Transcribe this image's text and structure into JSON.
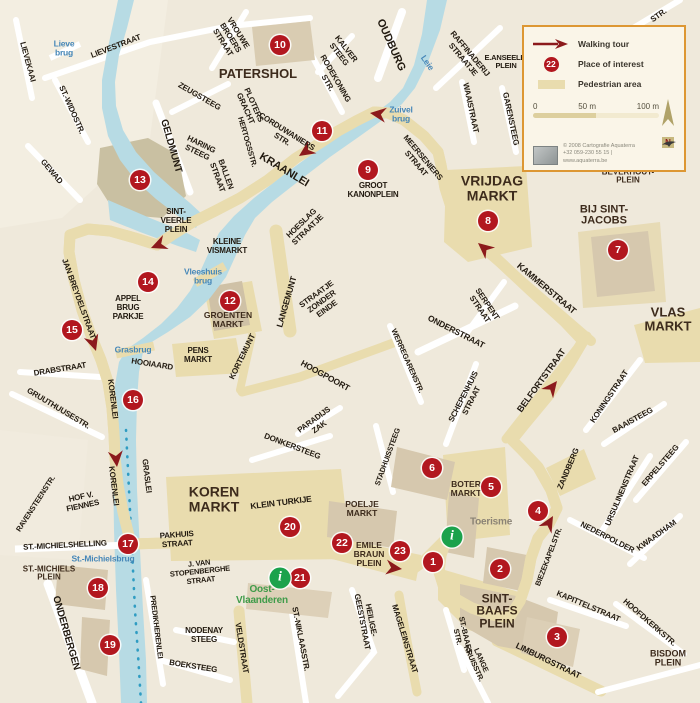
{
  "colors": {
    "water": "#b7dbe4",
    "route": "#8c1a1c",
    "poi": "#b2171f",
    "pedestrian": "#e9dcae",
    "info_green": "#1ba24c",
    "legend_border": "#dd9733",
    "water_label": "#4687b8"
  },
  "legend": {
    "walking_tour": "Walking tour",
    "poi_badge": "22",
    "place_of_interest": "Place of interest",
    "pedestrian_area": "Pedestrian area",
    "scale_0": "0",
    "scale_50": "50 m",
    "scale_100": "100 m",
    "compass": "N",
    "credit_1": "© 2008 Cartografie Aquaterra",
    "credit_2": "+32 059-230 55 15 | www.aquaterra.be"
  },
  "map": {
    "info_glyph": "i",
    "labels": [
      {
        "t": "LIEVEKAAI",
        "x": 27,
        "y": 62,
        "r": 75,
        "fs": 8,
        "k": "street"
      },
      {
        "t": "LIEVESTRAAT",
        "x": 116,
        "y": 47,
        "r": -21,
        "fs": 8,
        "k": "street"
      },
      {
        "t": "Lieve\nbrug",
        "x": 64,
        "y": 49,
        "r": 0,
        "fs": 8.5,
        "k": "water"
      },
      {
        "t": "ST.-WIDOSTR.",
        "x": 71,
        "y": 110,
        "r": 66,
        "fs": 8,
        "k": "street"
      },
      {
        "t": "GEWAD",
        "x": 51,
        "y": 172,
        "r": 50,
        "fs": 8,
        "k": "street"
      },
      {
        "t": "GELDMUNT",
        "x": 171,
        "y": 146,
        "r": 74,
        "fs": 10,
        "k": "street"
      },
      {
        "t": "VROUWE\nBROERS\nSTRAAT",
        "x": 230,
        "y": 38,
        "r": 58,
        "fs": 8,
        "k": "street"
      },
      {
        "t": "PATERSHOL",
        "x": 258,
        "y": 74,
        "r": 0,
        "fs": 13,
        "k": "area"
      },
      {
        "t": "KALVER\nSTEEG",
        "x": 342,
        "y": 52,
        "r": 52,
        "fs": 8,
        "k": "street"
      },
      {
        "t": "RODEKONING\nSTR.",
        "x": 331,
        "y": 81,
        "r": 60,
        "fs": 8,
        "k": "street"
      },
      {
        "t": "ZEUGSTEEG",
        "x": 199,
        "y": 97,
        "r": 30,
        "fs": 8,
        "k": "street"
      },
      {
        "t": "PLOTERS\nGRACHT",
        "x": 249,
        "y": 107,
        "r": 66,
        "fs": 8,
        "k": "street"
      },
      {
        "t": "HARING\nSTEEG",
        "x": 199,
        "y": 149,
        "r": 26,
        "fs": 8,
        "k": "street"
      },
      {
        "t": "HERTOGSSTR.",
        "x": 247,
        "y": 142,
        "r": 74,
        "fs": 7.5,
        "k": "street"
      },
      {
        "t": "BALLEN\nSTRAAT",
        "x": 221,
        "y": 176,
        "r": 70,
        "fs": 8,
        "k": "street"
      },
      {
        "t": "CORDUWANIERS\nSTR.",
        "x": 284,
        "y": 136,
        "r": 32,
        "fs": 8,
        "k": "street"
      },
      {
        "t": "KRAANLEI",
        "x": 284,
        "y": 170,
        "r": 31,
        "fs": 11,
        "k": "street"
      },
      {
        "t": "OUDBURG",
        "x": 391,
        "y": 45,
        "r": 66,
        "fs": 11,
        "k": "street"
      },
      {
        "t": "Leie",
        "x": 427,
        "y": 63,
        "r": 55,
        "fs": 8.5,
        "k": "water"
      },
      {
        "t": "RAFFINADERIJ\nSTRAATJE",
        "x": 466,
        "y": 57,
        "r": 50,
        "fs": 8,
        "k": "street"
      },
      {
        "t": "E.ANSEELE-\nPLEIN",
        "x": 506,
        "y": 62,
        "r": 0,
        "fs": 7.5,
        "k": "street"
      },
      {
        "t": "WAAISTRAAT",
        "x": 470,
        "y": 108,
        "r": 78,
        "fs": 8,
        "k": "street"
      },
      {
        "t": "GARENSTEEG",
        "x": 510,
        "y": 119,
        "r": 78,
        "fs": 8,
        "k": "street"
      },
      {
        "t": "STR.",
        "x": 659,
        "y": 16,
        "r": -36,
        "fs": 8,
        "k": "street"
      },
      {
        "t": "Zuivel\nbrug",
        "x": 401,
        "y": 115,
        "r": 0,
        "fs": 8.5,
        "k": "water"
      },
      {
        "t": "MEERSENIERS\nSTRAAT",
        "x": 419,
        "y": 161,
        "r": 50,
        "fs": 8,
        "k": "street"
      },
      {
        "t": "GROOT\nKANONPLEIN",
        "x": 373,
        "y": 191,
        "r": 0,
        "fs": 8,
        "k": "street"
      },
      {
        "t": "VRIJDAG\nMARKT",
        "x": 492,
        "y": 188,
        "r": 0,
        "fs": 14,
        "k": "area"
      },
      {
        "t": "BEVERHOUT-\nPLEIN",
        "x": 628,
        "y": 177,
        "r": 0,
        "fs": 8,
        "k": "area"
      },
      {
        "t": "BIJ SINT-\nJACOBS",
        "x": 604,
        "y": 216,
        "r": 0,
        "fs": 11,
        "k": "area"
      },
      {
        "t": "VLAS\nMARKT",
        "x": 668,
        "y": 319,
        "r": 0,
        "fs": 13,
        "k": "area"
      },
      {
        "t": "KAMMERSTRAAT",
        "x": 546,
        "y": 289,
        "r": 40,
        "fs": 9,
        "k": "street"
      },
      {
        "t": "SERPENT\nSTRAAT",
        "x": 483,
        "y": 307,
        "r": 56,
        "fs": 8,
        "k": "street"
      },
      {
        "t": "ONDERSTRAAT",
        "x": 456,
        "y": 332,
        "r": 27,
        "fs": 8.5,
        "k": "street"
      },
      {
        "t": "BELFORTSTRAAT",
        "x": 542,
        "y": 381,
        "r": -54,
        "fs": 9,
        "k": "street"
      },
      {
        "t": "KONINGSTRAAT",
        "x": 610,
        "y": 397,
        "r": -56,
        "fs": 8,
        "k": "street"
      },
      {
        "t": "BAAISTEEG",
        "x": 633,
        "y": 421,
        "r": -29,
        "fs": 8,
        "k": "street"
      },
      {
        "t": "ZANDBERG",
        "x": 569,
        "y": 469,
        "r": -67,
        "fs": 8,
        "k": "street"
      },
      {
        "t": "URSULINENSTRAAT",
        "x": 623,
        "y": 491,
        "r": -67,
        "fs": 8,
        "k": "street"
      },
      {
        "t": "ERPELSTEEG",
        "x": 661,
        "y": 466,
        "r": -49,
        "fs": 8,
        "k": "street"
      },
      {
        "t": "NEDERPOLDER",
        "x": 607,
        "y": 538,
        "r": 27,
        "fs": 8,
        "k": "street"
      },
      {
        "t": "KWAADHAM",
        "x": 657,
        "y": 536,
        "r": -36,
        "fs": 8,
        "k": "street"
      },
      {
        "t": "BIEZEKAPELSTR.",
        "x": 549,
        "y": 557,
        "r": -69,
        "fs": 7.5,
        "k": "street"
      },
      {
        "t": "KAPITTELSTRAAT",
        "x": 588,
        "y": 607,
        "r": 23,
        "fs": 8,
        "k": "street"
      },
      {
        "t": "HOOFDKERKSTR.",
        "x": 649,
        "y": 623,
        "r": 41,
        "fs": 8,
        "k": "street"
      },
      {
        "t": "BISDOM\nPLEIN",
        "x": 668,
        "y": 659,
        "r": 0,
        "fs": 9,
        "k": "area"
      },
      {
        "t": "LIMBURGSTRAAT",
        "x": 548,
        "y": 661,
        "r": 26,
        "fs": 8.5,
        "k": "street"
      },
      {
        "t": "SINT-\nBAAFS\nPLEIN",
        "x": 497,
        "y": 611,
        "r": 0,
        "fs": 12,
        "k": "area"
      },
      {
        "t": "ST.-BAAFS\nSTR.",
        "x": 461,
        "y": 636,
        "r": 77,
        "fs": 7.5,
        "k": "street"
      },
      {
        "t": "LANGE\nKRUISSTR.",
        "x": 477,
        "y": 662,
        "r": 66,
        "fs": 7.5,
        "k": "street"
      },
      {
        "t": "MAGELEINSTRAAT",
        "x": 404,
        "y": 639,
        "r": 73,
        "fs": 8,
        "k": "street"
      },
      {
        "t": "HEILIGE-\nGEESTSTRAAT",
        "x": 366,
        "y": 621,
        "r": 79,
        "fs": 8,
        "k": "street"
      },
      {
        "t": "ST.-NIKLAASSTR.",
        "x": 300,
        "y": 639,
        "r": 79,
        "fs": 8,
        "k": "street"
      },
      {
        "t": "VELDSTRAAT",
        "x": 241,
        "y": 648,
        "r": 81,
        "fs": 8,
        "k": "street"
      },
      {
        "t": "NODENAY\nSTEEG",
        "x": 204,
        "y": 636,
        "r": 0,
        "fs": 8,
        "k": "street"
      },
      {
        "t": "BOEKSTEEG",
        "x": 193,
        "y": 667,
        "r": 9,
        "fs": 8,
        "k": "street"
      },
      {
        "t": "PREDIKHERENLEI",
        "x": 156,
        "y": 627,
        "r": 83,
        "fs": 7.5,
        "k": "street"
      },
      {
        "t": "ONDERBERGEN",
        "x": 66,
        "y": 633,
        "r": 74,
        "fs": 10,
        "k": "street"
      },
      {
        "t": "ST.-MICHIELS\nPLEIN",
        "x": 49,
        "y": 574,
        "r": 0,
        "fs": 8,
        "k": "area"
      },
      {
        "t": "ST.-MICHIELSHELLING",
        "x": 65,
        "y": 546,
        "r": -3,
        "fs": 8,
        "k": "street"
      },
      {
        "t": "St.-Michielsbrug",
        "x": 103,
        "y": 559,
        "r": 0,
        "fs": 8.5,
        "k": "water"
      },
      {
        "t": "HOF V.\nFIENNES",
        "x": 82,
        "y": 502,
        "r": -12,
        "fs": 8,
        "k": "street"
      },
      {
        "t": "RAVENSTEENSTR.",
        "x": 36,
        "y": 504,
        "r": -57,
        "fs": 7.5,
        "k": "street"
      },
      {
        "t": "KORENLEI",
        "x": 112,
        "y": 399,
        "r": 83,
        "fs": 8,
        "k": "street"
      },
      {
        "t": "KORENLEI",
        "x": 113,
        "y": 486,
        "r": 83,
        "fs": 8,
        "k": "street"
      },
      {
        "t": "GRASLEI",
        "x": 146,
        "y": 476,
        "r": 83,
        "fs": 8,
        "k": "street"
      },
      {
        "t": "DRABSTRAAT",
        "x": 60,
        "y": 370,
        "r": -9,
        "fs": 8,
        "k": "street"
      },
      {
        "t": "GRUUTHUUSESTR.",
        "x": 58,
        "y": 409,
        "r": 31,
        "fs": 8,
        "k": "street"
      },
      {
        "t": "Grasbrug",
        "x": 133,
        "y": 350,
        "r": 0,
        "fs": 8.5,
        "k": "water"
      },
      {
        "t": "HOOIAARD",
        "x": 152,
        "y": 365,
        "r": 9,
        "fs": 8,
        "k": "street"
      },
      {
        "t": "APPEL\nBRUG\nPARKJE",
        "x": 128,
        "y": 308,
        "r": 0,
        "fs": 8,
        "k": "street"
      },
      {
        "t": "JAN BREYDELSTRAAT",
        "x": 78,
        "y": 299,
        "r": 70,
        "fs": 8,
        "k": "street"
      },
      {
        "t": "SINT-\nVEERLE\nPLEIN",
        "x": 176,
        "y": 221,
        "r": 0,
        "fs": 8,
        "k": "street"
      },
      {
        "t": "KLEINE\nVISMARKT",
        "x": 227,
        "y": 247,
        "r": 0,
        "fs": 8,
        "k": "street"
      },
      {
        "t": "Vleeshuis\nbrug",
        "x": 203,
        "y": 277,
        "r": 0,
        "fs": 8.5,
        "k": "water"
      },
      {
        "t": "GROENTEN\nMARKT",
        "x": 228,
        "y": 320,
        "r": 0,
        "fs": 8.5,
        "k": "area"
      },
      {
        "t": "LANGEMUNT",
        "x": 287,
        "y": 302,
        "r": -74,
        "fs": 8.5,
        "k": "street"
      },
      {
        "t": "STRAATJE\nZONDER\nEINDE",
        "x": 322,
        "y": 302,
        "r": -36,
        "fs": 8,
        "k": "street"
      },
      {
        "t": "HOESLAG\nSTRAATJE",
        "x": 305,
        "y": 227,
        "r": -44,
        "fs": 8,
        "k": "street"
      },
      {
        "t": "PENS\nMARKT",
        "x": 198,
        "y": 356,
        "r": 0,
        "fs": 8,
        "k": "street"
      },
      {
        "t": "KORTEMUNT",
        "x": 243,
        "y": 357,
        "r": -64,
        "fs": 8,
        "k": "street"
      },
      {
        "t": "HOOGPOORT",
        "x": 325,
        "y": 376,
        "r": 29,
        "fs": 8.5,
        "k": "street"
      },
      {
        "t": "PARADIJS\nZAK",
        "x": 317,
        "y": 424,
        "r": -36,
        "fs": 8,
        "k": "street"
      },
      {
        "t": "DONKERSTEEG",
        "x": 292,
        "y": 447,
        "r": 21,
        "fs": 8,
        "k": "street"
      },
      {
        "t": "WERREGARENSTR.",
        "x": 407,
        "y": 361,
        "r": 66,
        "fs": 7.5,
        "k": "street"
      },
      {
        "t": "SCHEPENHUIS\nSTRAAT",
        "x": 468,
        "y": 399,
        "r": -63,
        "fs": 8,
        "k": "street"
      },
      {
        "t": "STADHUISSTEEG",
        "x": 388,
        "y": 457,
        "r": -70,
        "fs": 7.5,
        "k": "street"
      },
      {
        "t": "BOTER\nMARKT",
        "x": 466,
        "y": 489,
        "r": 0,
        "fs": 8.5,
        "k": "area"
      },
      {
        "t": "Toerisme",
        "x": 491,
        "y": 522,
        "r": 0,
        "fs": 10,
        "k": "gray"
      },
      {
        "t": "KOREN\nMARKT",
        "x": 214,
        "y": 499,
        "r": 0,
        "fs": 14,
        "k": "area"
      },
      {
        "t": "KLEIN TURKIJE",
        "x": 281,
        "y": 503,
        "r": -7,
        "fs": 8.5,
        "k": "street"
      },
      {
        "t": "POELJE\nMARKT",
        "x": 362,
        "y": 509,
        "r": 0,
        "fs": 8.5,
        "k": "area"
      },
      {
        "t": "EMILE\nBRAUN\nPLEIN",
        "x": 369,
        "y": 554,
        "r": 0,
        "fs": 8.5,
        "k": "area"
      },
      {
        "t": "PAKHUIS\nSTRAAT",
        "x": 177,
        "y": 540,
        "r": -4,
        "fs": 8,
        "k": "street"
      },
      {
        "t": "J. VAN\nSTOPENBERGHE\nSTRAAT",
        "x": 200,
        "y": 572,
        "r": -6,
        "fs": 7.5,
        "k": "street"
      },
      {
        "t": "Oost-\nVlaanderen",
        "x": 262,
        "y": 595,
        "r": 0,
        "fs": 10,
        "k": "green"
      }
    ],
    "pois": [
      {
        "n": "1",
        "x": 433,
        "y": 562
      },
      {
        "n": "2",
        "x": 500,
        "y": 569
      },
      {
        "n": "3",
        "x": 557,
        "y": 637
      },
      {
        "n": "4",
        "x": 538,
        "y": 511
      },
      {
        "n": "5",
        "x": 491,
        "y": 487
      },
      {
        "n": "6",
        "x": 432,
        "y": 468
      },
      {
        "n": "7",
        "x": 618,
        "y": 250
      },
      {
        "n": "8",
        "x": 488,
        "y": 221
      },
      {
        "n": "9",
        "x": 368,
        "y": 170
      },
      {
        "n": "10",
        "x": 280,
        "y": 45
      },
      {
        "n": "11",
        "x": 322,
        "y": 131
      },
      {
        "n": "12",
        "x": 230,
        "y": 301
      },
      {
        "n": "13",
        "x": 140,
        "y": 180
      },
      {
        "n": "14",
        "x": 148,
        "y": 282
      },
      {
        "n": "15",
        "x": 72,
        "y": 330
      },
      {
        "n": "16",
        "x": 133,
        "y": 400
      },
      {
        "n": "17",
        "x": 128,
        "y": 544
      },
      {
        "n": "18",
        "x": 98,
        "y": 588
      },
      {
        "n": "19",
        "x": 110,
        "y": 645
      },
      {
        "n": "20",
        "x": 290,
        "y": 527
      },
      {
        "n": "21",
        "x": 300,
        "y": 578
      },
      {
        "n": "22",
        "x": 342,
        "y": 543
      },
      {
        "n": "23",
        "x": 400,
        "y": 551
      }
    ],
    "info_markers": [
      {
        "x": 452,
        "y": 537
      },
      {
        "x": 280,
        "y": 578
      }
    ]
  }
}
